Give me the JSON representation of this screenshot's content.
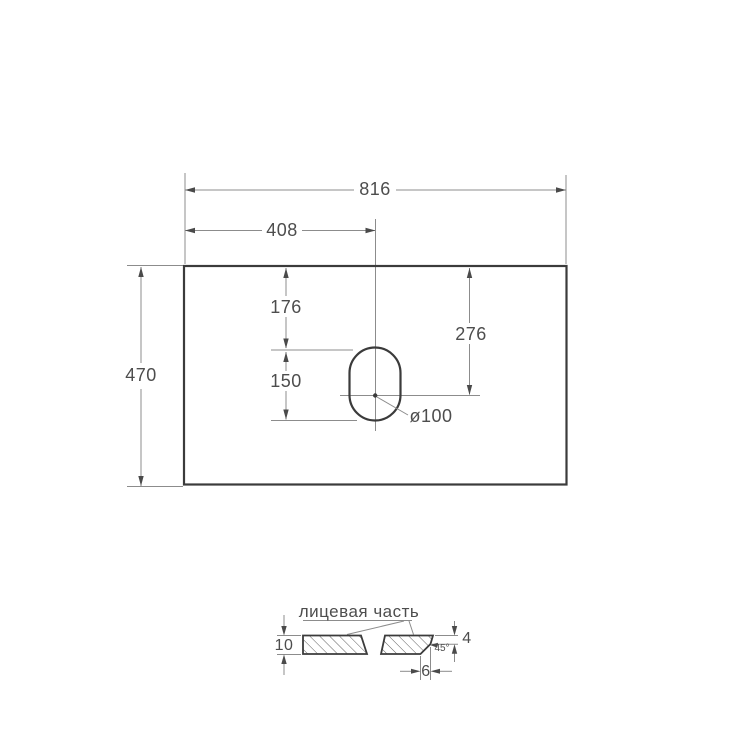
{
  "drawing": {
    "title": "countertop-technical-drawing",
    "top_view": {
      "width": "816",
      "half_width": "408",
      "depth": "470",
      "hole_top_offset": "176",
      "hole_center_from_top": "276",
      "hole_length": "150",
      "hole_diameter": "ø100"
    },
    "section": {
      "caption": "лицевая часть",
      "thickness": "10",
      "edge_face_height": "4",
      "chamfer_angle": "45°",
      "chamfer_depth": "6"
    },
    "colors": {
      "outline": "#3b3b3b",
      "thin_line": "#8c8c8c",
      "text": "#4d4d4d",
      "background": "#ffffff"
    }
  }
}
